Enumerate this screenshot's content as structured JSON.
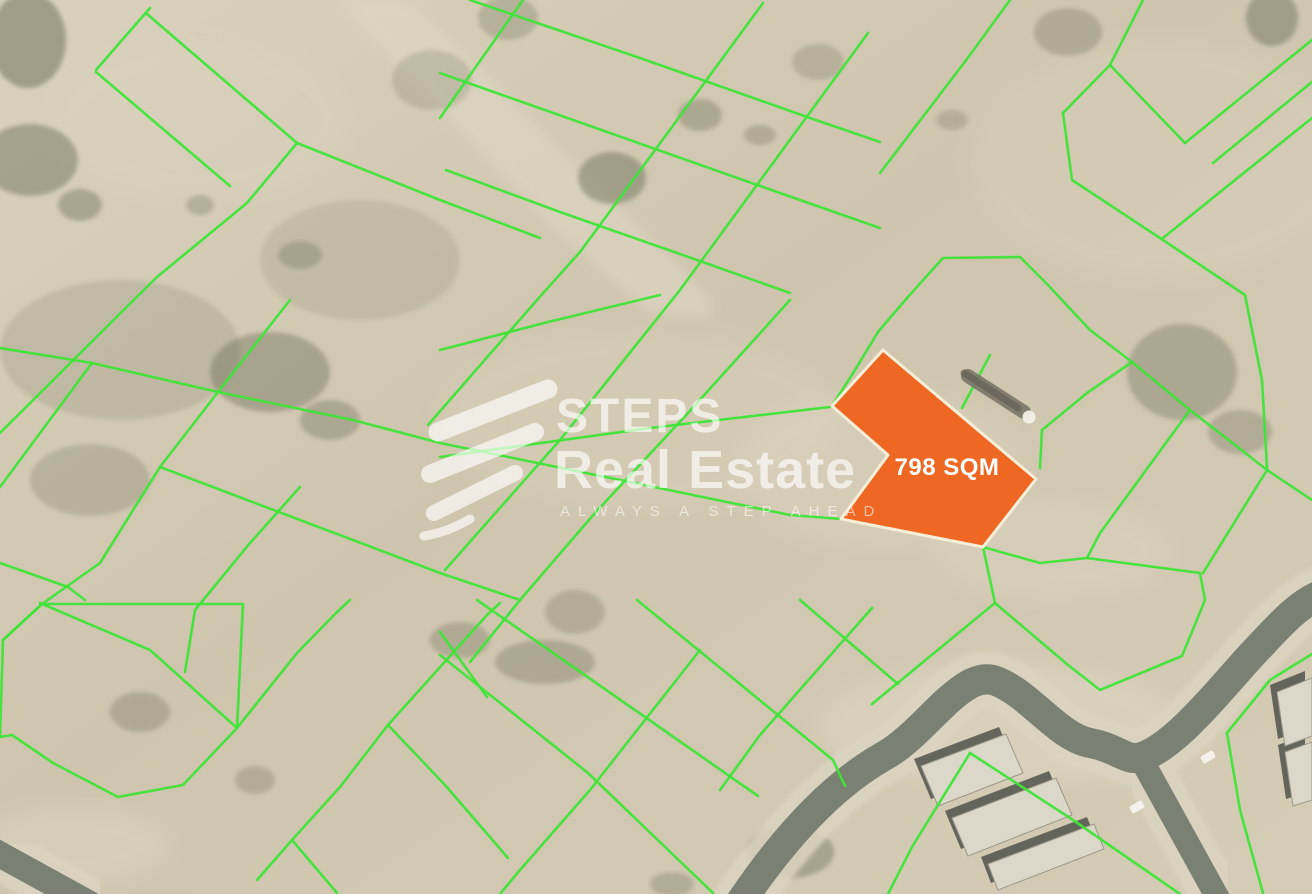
{
  "map": {
    "plot": {
      "label": "798 SQM",
      "fill": "#ee6723",
      "border": "#f6eed6",
      "label_color": "#ffffff",
      "points": [
        [
          883,
          350
        ],
        [
          1036,
          479
        ],
        [
          983,
          547
        ],
        [
          841,
          519
        ],
        [
          888,
          455
        ],
        [
          832,
          406
        ]
      ]
    },
    "watermark": {
      "title": "STEPS",
      "subtitle": "Real Estate",
      "tagline": "ALWAYS A STEP AHEAD",
      "color": "rgba(255,255,255,0.65)",
      "tagline_color": "rgba(255,255,255,0.58)"
    },
    "colors": {
      "parcel_line": "#3fe437",
      "sand_1": "#d9d1bc",
      "sand_2": "#cfc5ae",
      "sand_3": "#d5ccb6",
      "road_core": "#7b8172",
      "road_shoulder": "#dbd4c1",
      "building": "#dcd8c9",
      "building_shadow": "#50544a",
      "vegetation": "#686c55",
      "track_light": "#e0d9c6",
      "tank_body": "#7a7668",
      "tank_cap": "#f2f0e6",
      "car": "#f4f2ea"
    },
    "parcel_lines": [
      [
        [
          150,
          8
        ],
        [
          96,
          70
        ]
      ],
      [
        [
          147,
          14
        ],
        [
          297,
          143
        ],
        [
          440,
          200
        ],
        [
          540,
          238
        ]
      ],
      [
        [
          96,
          72
        ],
        [
          230,
          186
        ]
      ],
      [
        [
          297,
          143
        ],
        [
          247,
          203
        ],
        [
          157,
          277
        ],
        [
          0,
          433
        ]
      ],
      [
        [
          0,
          348
        ],
        [
          92,
          363
        ],
        [
          218,
          392
        ]
      ],
      [
        [
          92,
          363
        ],
        [
          0,
          487
        ]
      ],
      [
        [
          290,
          300
        ],
        [
          218,
          392
        ],
        [
          160,
          467
        ],
        [
          100,
          563
        ],
        [
          42,
          604
        ],
        [
          3,
          640
        ]
      ],
      [
        [
          523,
          0
        ],
        [
          475,
          68
        ],
        [
          440,
          118
        ]
      ],
      [
        [
          763,
          3
        ],
        [
          672,
          127
        ],
        [
          580,
          252
        ],
        [
          537,
          300
        ],
        [
          428,
          425
        ]
      ],
      [
        [
          868,
          33
        ],
        [
          773,
          163
        ],
        [
          680,
          290
        ],
        [
          560,
          440
        ],
        [
          445,
          570
        ]
      ],
      [
        [
          1010,
          0
        ],
        [
          967,
          59
        ],
        [
          880,
          173
        ]
      ],
      [
        [
          790,
          300
        ],
        [
          688,
          413
        ],
        [
          595,
          513
        ],
        [
          520,
          600
        ],
        [
          470,
          662
        ]
      ],
      [
        [
          470,
          0
        ],
        [
          640,
          58
        ],
        [
          810,
          118
        ],
        [
          880,
          142
        ]
      ],
      [
        [
          440,
          73
        ],
        [
          610,
          133
        ],
        [
          780,
          193
        ],
        [
          880,
          228
        ]
      ],
      [
        [
          446,
          170
        ],
        [
          560,
          212
        ],
        [
          680,
          254
        ],
        [
          790,
          293
        ]
      ],
      [
        [
          440,
          350
        ],
        [
          548,
          322
        ],
        [
          660,
          295
        ]
      ],
      [
        [
          218,
          392
        ],
        [
          353,
          420
        ],
        [
          440,
          443
        ],
        [
          620,
          480
        ],
        [
          790,
          515
        ],
        [
          841,
          519
        ]
      ],
      [
        [
          160,
          467
        ],
        [
          300,
          520
        ],
        [
          440,
          573
        ],
        [
          520,
          600
        ]
      ],
      [
        [
          0,
          563
        ],
        [
          68,
          587
        ],
        [
          85,
          600
        ]
      ],
      [
        [
          300,
          487
        ],
        [
          250,
          543
        ],
        [
          195,
          610
        ],
        [
          185,
          672
        ]
      ],
      [
        [
          440,
          457
        ],
        [
          650,
          428
        ],
        [
          830,
          407
        ]
      ],
      [
        [
          42,
          604
        ],
        [
          3,
          640
        ],
        [
          0,
          737
        ],
        [
          12,
          735
        ],
        [
          53,
          763
        ],
        [
          118,
          797
        ],
        [
          183,
          785
        ],
        [
          237,
          728
        ],
        [
          243,
          604
        ],
        [
          42,
          604
        ]
      ],
      [
        [
          40,
          603
        ],
        [
          150,
          650
        ],
        [
          237,
          728
        ]
      ],
      [
        [
          350,
          600
        ],
        [
          337,
          612
        ],
        [
          297,
          653
        ],
        [
          237,
          728
        ]
      ],
      [
        [
          388,
          725
        ],
        [
          487,
          615
        ],
        [
          500,
          603
        ]
      ],
      [
        [
          388,
          725
        ],
        [
          340,
          787
        ],
        [
          292,
          840
        ],
        [
          337,
          893
        ]
      ],
      [
        [
          292,
          840
        ],
        [
          257,
          880
        ]
      ],
      [
        [
          388,
          725
        ],
        [
          445,
          785
        ],
        [
          508,
          858
        ]
      ],
      [
        [
          440,
          632
        ],
        [
          487,
          697
        ]
      ],
      [
        [
          440,
          655
        ],
        [
          588,
          773
        ],
        [
          713,
          893
        ]
      ],
      [
        [
          477,
          600
        ],
        [
          645,
          717
        ],
        [
          758,
          796
        ]
      ],
      [
        [
          637,
          600
        ],
        [
          833,
          760
        ],
        [
          845,
          786
        ]
      ],
      [
        [
          800,
          600
        ],
        [
          898,
          684
        ]
      ],
      [
        [
          700,
          650
        ],
        [
          590,
          790
        ],
        [
          520,
          870
        ],
        [
          500,
          894
        ]
      ],
      [
        [
          872,
          608
        ],
        [
          760,
          735
        ],
        [
          720,
          790
        ]
      ],
      [
        [
          907,
          298
        ],
        [
          943,
          258
        ],
        [
          1020,
          257
        ],
        [
          1048,
          285
        ],
        [
          1090,
          330
        ],
        [
          1132,
          362
        ],
        [
          1190,
          410
        ],
        [
          1267,
          470
        ],
        [
          1312,
          500
        ]
      ],
      [
        [
          907,
          298
        ],
        [
          878,
          332
        ]
      ],
      [
        [
          878,
          332
        ],
        [
          855,
          370
        ],
        [
          832,
          406
        ]
      ],
      [
        [
          990,
          355
        ],
        [
          962,
          408
        ]
      ],
      [
        [
          1132,
          362
        ],
        [
          1087,
          393
        ],
        [
          1042,
          430
        ],
        [
          1040,
          468
        ]
      ],
      [
        [
          1190,
          410
        ],
        [
          1100,
          533
        ],
        [
          1087,
          558
        ]
      ],
      [
        [
          1267,
          470
        ],
        [
          1203,
          573
        ]
      ],
      [
        [
          1063,
          113
        ],
        [
          1110,
          65
        ],
        [
          1143,
          0
        ]
      ],
      [
        [
          1063,
          113
        ],
        [
          1072,
          180
        ],
        [
          1163,
          240
        ],
        [
          1245,
          295
        ]
      ],
      [
        [
          1245,
          295
        ],
        [
          1262,
          380
        ],
        [
          1267,
          468
        ]
      ],
      [
        [
          1110,
          65
        ],
        [
          1185,
          143
        ]
      ],
      [
        [
          1185,
          143
        ],
        [
          1312,
          40
        ]
      ],
      [
        [
          1213,
          163
        ],
        [
          1312,
          82
        ]
      ],
      [
        [
          1163,
          238
        ],
        [
          1312,
          118
        ]
      ],
      [
        [
          872,
          704
        ],
        [
          995,
          603
        ],
        [
          1068,
          665
        ],
        [
          1100,
          690
        ],
        [
          1182,
          656
        ],
        [
          1205,
          600
        ],
        [
          1200,
          573
        ],
        [
          1087,
          558
        ],
        [
          1040,
          563
        ],
        [
          983,
          547
        ]
      ],
      [
        [
          983,
          547
        ],
        [
          995,
          603
        ]
      ],
      [
        [
          970,
          753
        ],
        [
          912,
          847
        ],
        [
          888,
          894
        ]
      ],
      [
        [
          970,
          753
        ],
        [
          1070,
          818
        ],
        [
          1180,
          894
        ]
      ],
      [
        [
          1227,
          733
        ],
        [
          1270,
          680
        ],
        [
          1312,
          654
        ]
      ],
      [
        [
          1227,
          733
        ],
        [
          1240,
          810
        ],
        [
          1263,
          893
        ]
      ]
    ],
    "roads": [
      {
        "d": "M 738 906 C 790 828 838 782 884 756 C 926 733 962 668 996 681 C 1030 694 1058 737 1090 743 C 1118 748 1126 762 1142 757 C 1180 744 1232 674 1260 646 C 1286 618 1300 604 1320 595",
        "w": 30
      },
      {
        "d": "M -10 849 L 90 904",
        "w": 26
      },
      {
        "d": "M 1140 757 L 1220 902",
        "w": 24
      }
    ],
    "corridor": [
      [
        335,
        0
      ],
      [
        410,
        0
      ],
      [
        708,
        296
      ],
      [
        712,
        318
      ],
      [
        652,
        314
      ],
      [
        558,
        232
      ]
    ],
    "vegetation": [
      [
        28,
        40,
        38,
        48,
        0.5
      ],
      [
        30,
        160,
        48,
        36,
        0.45
      ],
      [
        80,
        205,
        22,
        16,
        0.4
      ],
      [
        270,
        372,
        60,
        40,
        0.4
      ],
      [
        330,
        420,
        30,
        20,
        0.35
      ],
      [
        300,
        255,
        22,
        14,
        0.3
      ],
      [
        612,
        178,
        34,
        26,
        0.45
      ],
      [
        700,
        115,
        22,
        16,
        0.35
      ],
      [
        760,
        135,
        16,
        10,
        0.3
      ],
      [
        200,
        205,
        14,
        10,
        0.3
      ],
      [
        90,
        480,
        60,
        36,
        0.25
      ],
      [
        460,
        640,
        30,
        18,
        0.3
      ],
      [
        545,
        662,
        50,
        22,
        0.33
      ],
      [
        575,
        612,
        30,
        22,
        0.28
      ],
      [
        790,
        852,
        44,
        26,
        0.4
      ],
      [
        672,
        884,
        22,
        12,
        0.3
      ],
      [
        1182,
        372,
        55,
        48,
        0.35
      ],
      [
        1240,
        432,
        32,
        22,
        0.3
      ],
      [
        1068,
        32,
        34,
        24,
        0.3
      ],
      [
        1272,
        18,
        26,
        28,
        0.45
      ],
      [
        140,
        712,
        30,
        20,
        0.3
      ],
      [
        255,
        780,
        20,
        14,
        0.28
      ],
      [
        432,
        80,
        40,
        30,
        0.22
      ],
      [
        508,
        18,
        30,
        22,
        0.28
      ],
      [
        818,
        62,
        26,
        18,
        0.25
      ],
      [
        952,
        120,
        16,
        10,
        0.25
      ],
      [
        360,
        260,
        100,
        60,
        0.15
      ],
      [
        120,
        350,
        120,
        70,
        0.18
      ]
    ],
    "light_patches": [
      [
        1000,
        725,
        180,
        60,
        0.45
      ],
      [
        75,
        845,
        95,
        40,
        0.4
      ],
      [
        880,
        470,
        140,
        80,
        0.3
      ],
      [
        1160,
        160,
        190,
        120,
        0.25
      ],
      [
        640,
        420,
        200,
        90,
        0.25
      ],
      [
        200,
        120,
        150,
        80,
        0.2
      ],
      [
        1050,
        550,
        120,
        50,
        0.3
      ]
    ],
    "buildings": [
      [
        [
          921,
          766
        ],
        [
          1006,
          734
        ],
        [
          1023,
          773
        ],
        [
          938,
          806
        ]
      ],
      [
        [
          952,
          818
        ],
        [
          1056,
          778
        ],
        [
          1072,
          815
        ],
        [
          968,
          856
        ]
      ],
      [
        [
          988,
          864
        ],
        [
          1094,
          824
        ],
        [
          1104,
          849
        ],
        [
          998,
          890
        ]
      ],
      [
        [
          1277,
          692
        ],
        [
          1312,
          678
        ],
        [
          1312,
          736
        ],
        [
          1285,
          746
        ]
      ],
      [
        [
          1285,
          752
        ],
        [
          1312,
          742
        ],
        [
          1312,
          800
        ],
        [
          1293,
          806
        ]
      ]
    ],
    "cars": [
      [
        1137,
        807
      ],
      [
        1208,
        757
      ]
    ],
    "tank": {
      "x1": 968,
      "y1": 376,
      "x2": 1024,
      "y2": 412,
      "cap_x": 1029,
      "cap_y": 417
    }
  }
}
